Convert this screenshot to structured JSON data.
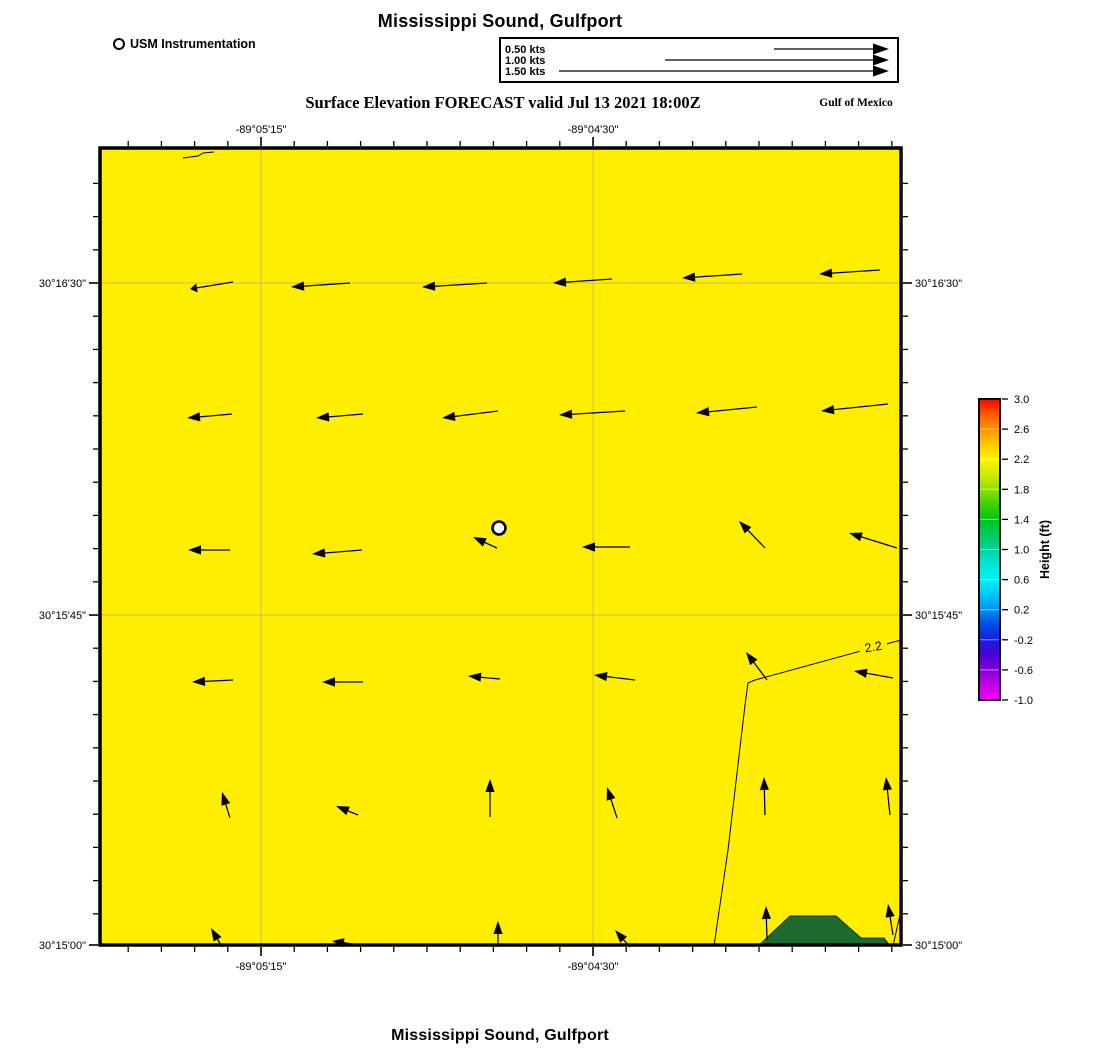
{
  "header": {
    "title": "Mississippi Sound, Gulfport",
    "instrument_legend": "USM Instrumentation",
    "subtitle": "Surface Elevation FORECAST valid Jul 13 2021 18:00Z",
    "region_label": "Gulf of Mexico"
  },
  "footer": {
    "title": "Mississippi Sound, Gulfport"
  },
  "velocity_legend": {
    "rows": [
      {
        "label": "0.50 kts",
        "kts": 0.5,
        "arrow_len": 115
      },
      {
        "label": "1.00 kts",
        "kts": 1.0,
        "arrow_len": 224
      },
      {
        "label": "1.50 kts",
        "kts": 1.5,
        "arrow_len": 330
      }
    ]
  },
  "chart_data": {
    "type": "map",
    "map_kind": "surface-elevation-forecast-with-current-vectors",
    "title": "Mississippi Sound, Gulfport",
    "subtitle": "Surface Elevation FORECAST valid Jul 13 2021 18:00Z",
    "region": "Gulf of Mexico",
    "valid_time": "Jul 13 2021 18:00Z",
    "water_color": "#ffee00",
    "water_level_ft": 2.2,
    "grid_color": "#9a9a9a",
    "map_rect": {
      "x": 100,
      "y": 148,
      "w": 801,
      "h": 797
    },
    "minor_tick_step": 33.2,
    "x_axis": {
      "major": [
        {
          "label": "-89°05'15\"",
          "fx": 0.201
        },
        {
          "label": "-89°04'30\"",
          "fx": 0.6155
        }
      ]
    },
    "y_axis": {
      "major": [
        {
          "label": "30°16'30\"",
          "fy": 0.1694
        },
        {
          "label": "30°15'45\"",
          "fy": 0.586
        },
        {
          "label": "30°15'00\"",
          "fy": 1.0
        }
      ]
    },
    "instrument": {
      "x": 499,
      "y": 528,
      "label": "USM Instrumentation"
    },
    "land": {
      "color": "#1e6b2f",
      "polygon": [
        [
          758,
          946
        ],
        [
          790,
          916
        ],
        [
          836,
          916
        ],
        [
          861,
          938
        ],
        [
          884,
          938
        ],
        [
          890,
          946
        ]
      ]
    },
    "contours": {
      "level_label": "2.2",
      "label_pos": {
        "x": 874,
        "y": 651,
        "rotate": -10
      },
      "paths": [
        [
          [
            901,
            640
          ],
          [
            755,
            680
          ],
          [
            748,
            683
          ],
          [
            745,
            705
          ],
          [
            728,
            850
          ],
          [
            714,
            946
          ]
        ],
        [
          [
            901,
            910
          ],
          [
            893,
            946
          ]
        ],
        [
          [
            183,
            158
          ],
          [
            198,
            156
          ],
          [
            203,
            153
          ],
          [
            214,
            152
          ]
        ]
      ]
    },
    "colorbar": {
      "x": 979,
      "y": 399,
      "w": 21,
      "h": 301,
      "title": "Height (ft)",
      "tick_labels": [
        "3.0",
        "2.6",
        "2.2",
        "1.8",
        "1.4",
        "1.0",
        "0.6",
        "0.2",
        "-0.2",
        "-0.6",
        "-1.0"
      ],
      "stops": [
        {
          "p": 0,
          "c": "#fa0000"
        },
        {
          "p": 5,
          "c": "#ff5a00"
        },
        {
          "p": 10,
          "c": "#ff9400"
        },
        {
          "p": 15,
          "c": "#ffc800"
        },
        {
          "p": 20,
          "c": "#fff200"
        },
        {
          "p": 25,
          "c": "#d0ec00"
        },
        {
          "p": 30,
          "c": "#8fe000"
        },
        {
          "p": 35,
          "c": "#3cd200"
        },
        {
          "p": 40,
          "c": "#00c41c"
        },
        {
          "p": 45,
          "c": "#00ca60"
        },
        {
          "p": 50,
          "c": "#00d49e"
        },
        {
          "p": 55,
          "c": "#00e6d6"
        },
        {
          "p": 60,
          "c": "#00f2f2"
        },
        {
          "p": 65,
          "c": "#00c6f6"
        },
        {
          "p": 70,
          "c": "#0092ee"
        },
        {
          "p": 75,
          "c": "#004ae6"
        },
        {
          "p": 80,
          "c": "#1c1cdd"
        },
        {
          "p": 85,
          "c": "#4a00d8"
        },
        {
          "p": 90,
          "c": "#8400d8"
        },
        {
          "p": 95,
          "c": "#c400e8"
        },
        {
          "p": 100,
          "c": "#f400f4"
        }
      ]
    },
    "arrows": [
      [
        233,
        282,
        190,
        289,
        7
      ],
      [
        350,
        283,
        291,
        287
      ],
      [
        487,
        283,
        422,
        287
      ],
      [
        612,
        279,
        553,
        283
      ],
      [
        742,
        274,
        682,
        278
      ],
      [
        880,
        270,
        819,
        274
      ],
      [
        232,
        414,
        187,
        418
      ],
      [
        363,
        414,
        316,
        418
      ],
      [
        498,
        411,
        442,
        418
      ],
      [
        625,
        411,
        559,
        415
      ],
      [
        757,
        407,
        696,
        413
      ],
      [
        888,
        404,
        821,
        411
      ],
      [
        230,
        550,
        188,
        550
      ],
      [
        362,
        550,
        312,
        554
      ],
      [
        497,
        548,
        473,
        537
      ],
      [
        630,
        547,
        582,
        547
      ],
      [
        765,
        548,
        739,
        521
      ],
      [
        897,
        548,
        849,
        533
      ],
      [
        233,
        680,
        192,
        682
      ],
      [
        363,
        682,
        322,
        682
      ],
      [
        500,
        679,
        468,
        676
      ],
      [
        635,
        680,
        594,
        675
      ],
      [
        767,
        680,
        746,
        652
      ],
      [
        893,
        678,
        854,
        671
      ],
      [
        230,
        818,
        222,
        792
      ],
      [
        358,
        815,
        336,
        806
      ],
      [
        490,
        817,
        490,
        779
      ],
      [
        617,
        818,
        607,
        787
      ],
      [
        765,
        815,
        764,
        777
      ],
      [
        890,
        815,
        886,
        777
      ],
      [
        222,
        947,
        211,
        928
      ],
      [
        353,
        944,
        332,
        941,
        12
      ],
      [
        498,
        947,
        498,
        921
      ],
      [
        630,
        947,
        615,
        930
      ],
      [
        767,
        940,
        766,
        906
      ],
      [
        893,
        935,
        888,
        904
      ]
    ]
  }
}
